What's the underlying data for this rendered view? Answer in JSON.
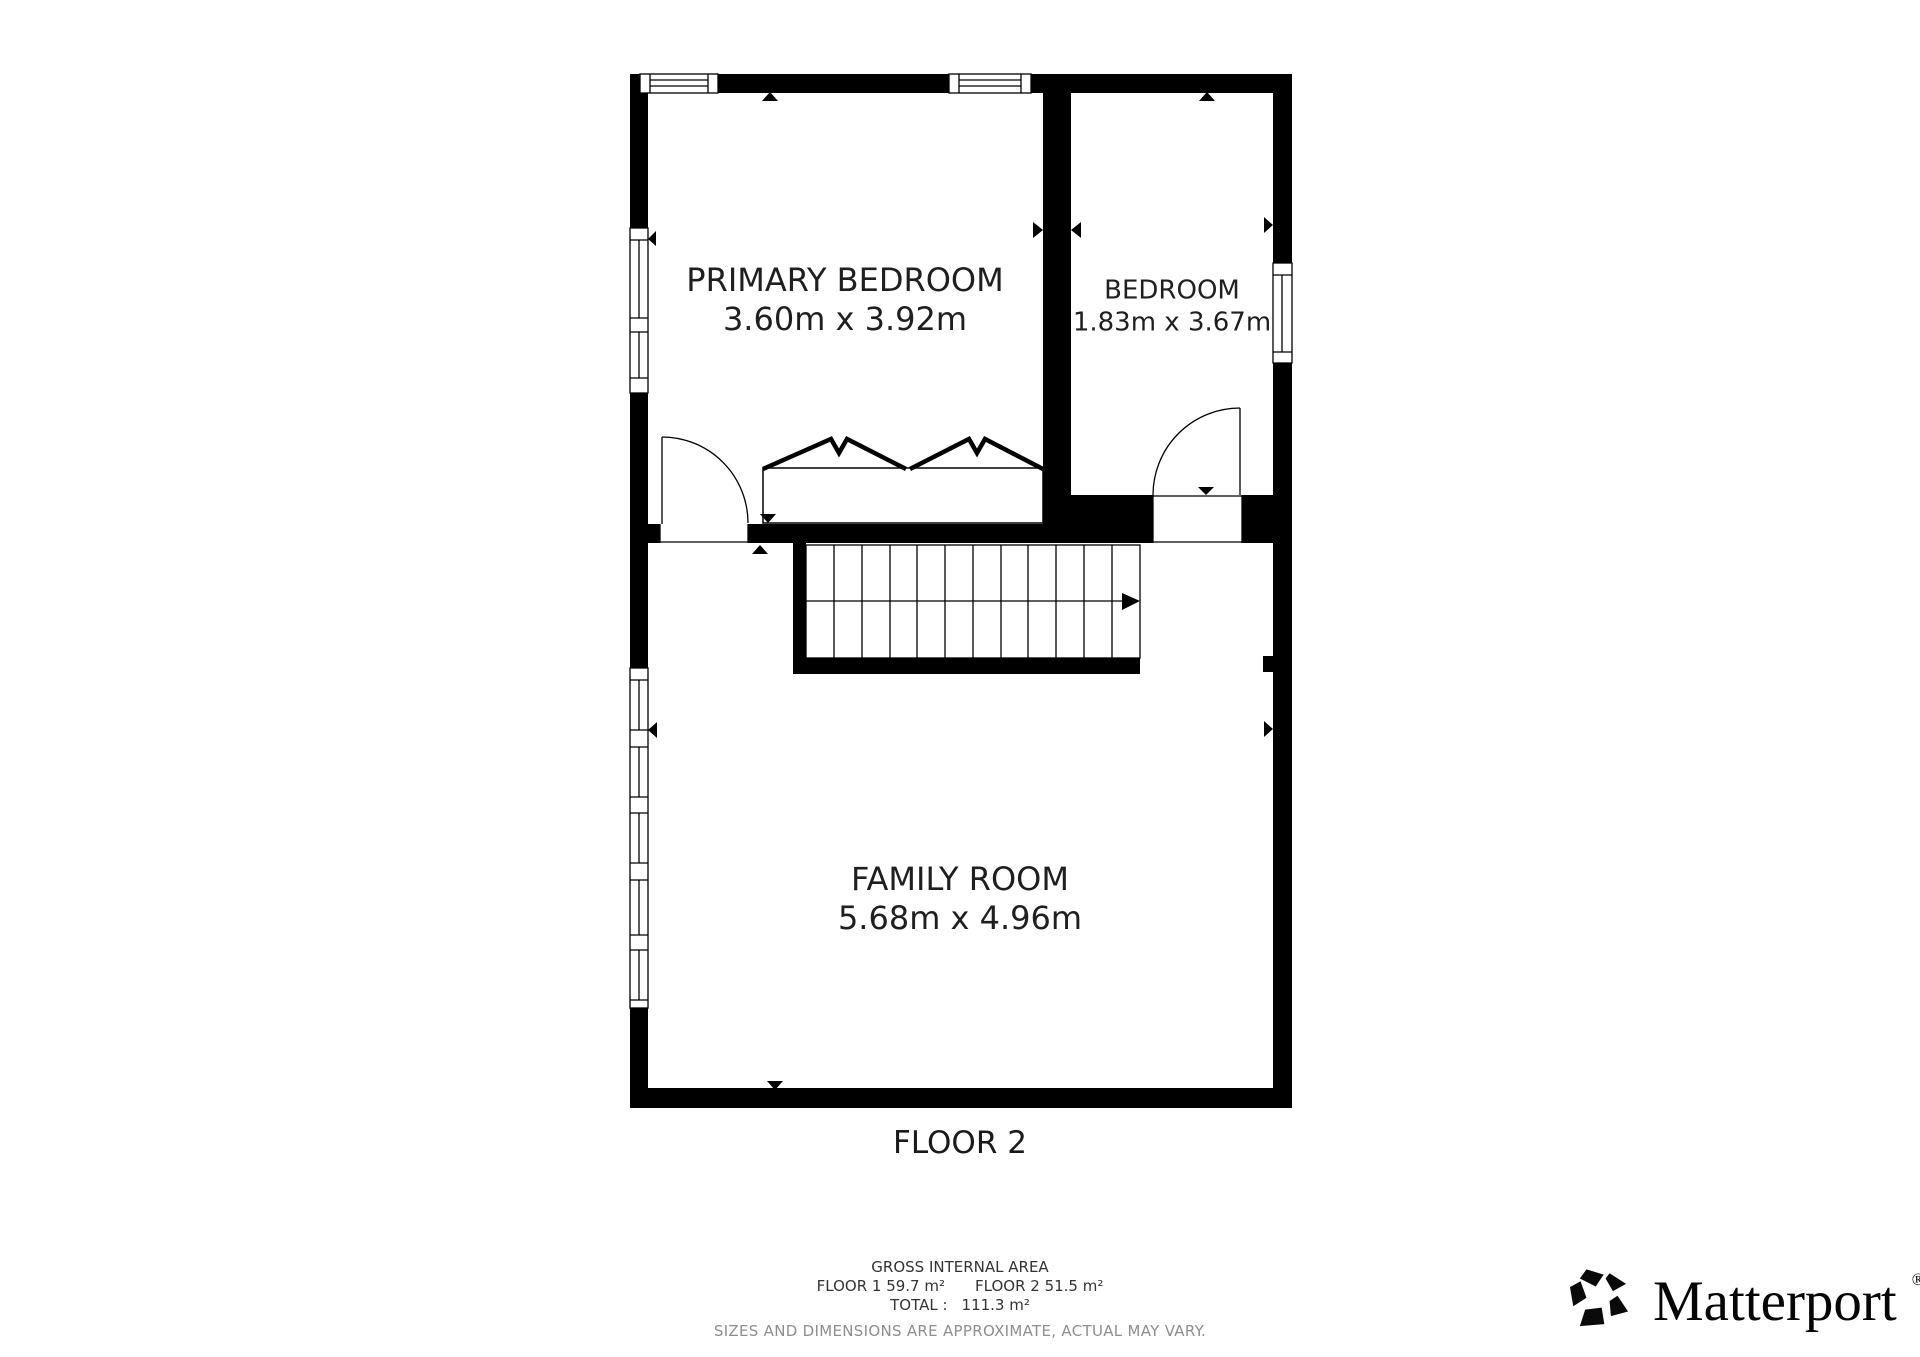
{
  "plan": {
    "floor_label": "FLOOR 2",
    "rooms": [
      {
        "name": "PRIMARY BEDROOM",
        "dimensions": "3.60m x 3.92m"
      },
      {
        "name": "BEDROOM",
        "dimensions": "1.83m x 3.67m"
      },
      {
        "name": "FAMILY ROOM",
        "dimensions": "5.68m x 4.96m"
      }
    ]
  },
  "footer": {
    "title": "GROSS INTERNAL AREA",
    "floor1_area": "FLOOR 1 59.7 m²",
    "floor2_area": "FLOOR 2 51.5 m²",
    "total_label": "TOTAL :",
    "total_value": "111.3 m²",
    "disclaimer": "SIZES AND DIMENSIONS ARE APPROXIMATE, ACTUAL MAY VARY."
  },
  "branding": {
    "logo_text": "Matterport",
    "registered_mark": "®"
  },
  "colors": {
    "background": "#ffffff",
    "wall": "#000000",
    "label_text": "#1f1f1f",
    "footer_text": "#333333",
    "disclaimer_text": "#8e8e8e"
  }
}
